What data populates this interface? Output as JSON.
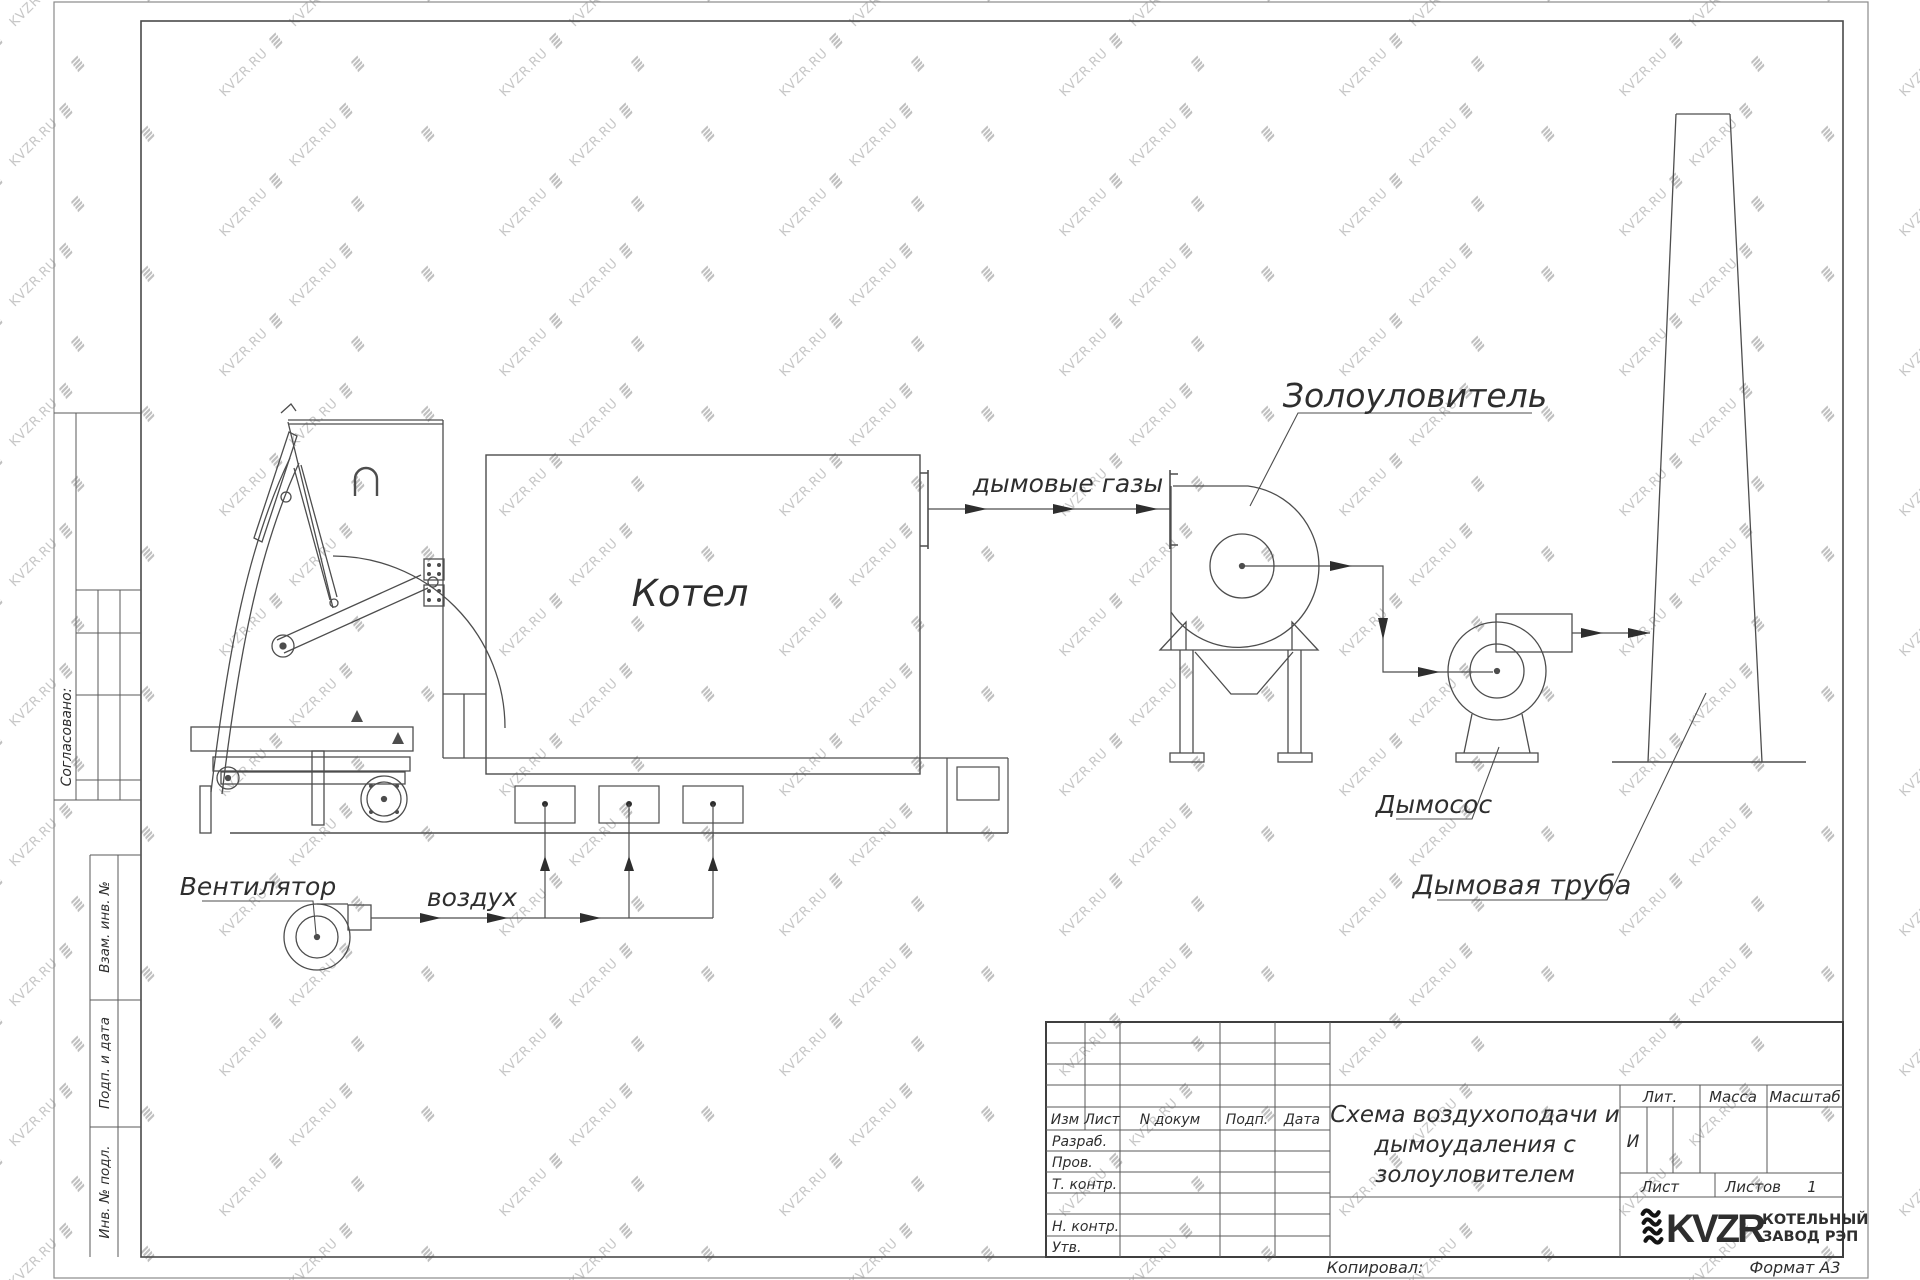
{
  "sheet": {
    "watermark_text": "KVZR.RU",
    "copied_label": "Копировал:",
    "format_label": "Формат А3"
  },
  "margin": {
    "approved": "Согласовано:",
    "subst_inv": "Взам. инв. №",
    "sign_date": "Подп. и дата",
    "inv_original": "Инв. № подл."
  },
  "diagram": {
    "labels": {
      "boiler": "Котел",
      "fan": "Вентилятор",
      "air": "воздух",
      "flue_gases": "дымовые газы",
      "ash_collector": "Золоуловитель",
      "smoke_exhauster": "Дымосос",
      "chimney": "Дымовая труба"
    }
  },
  "title_block": {
    "header": {
      "izm": "Изм",
      "list": "Лист",
      "doc": "N докум",
      "sign": "Подп.",
      "date": "Дата"
    },
    "roles": {
      "developed": "Разраб.",
      "checked": "Пров.",
      "t_control": "Т. контр.",
      "n_control": "Н. контр.",
      "approved": "Утв."
    },
    "doc_title": {
      "line1": "Схема воздухоподачи и",
      "line2": "дымоудаления с",
      "line3": "золоуловителем"
    },
    "lit_label": "Лит.",
    "lit_value": "И",
    "mass_label": "Масса",
    "scale_label": "Масштаб",
    "sheet_label": "Лист",
    "sheets_label": "Листов",
    "sheets_value": "1",
    "company": {
      "logo": "KVZR",
      "name1": "КОТЕЛЬНЫЙ",
      "name2": "ЗАВОД РЭП"
    }
  }
}
